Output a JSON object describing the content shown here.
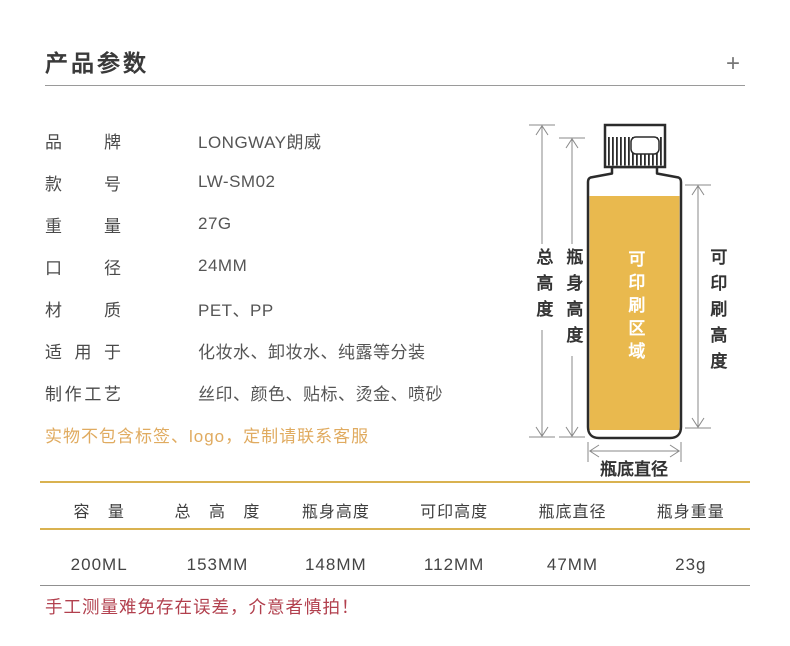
{
  "header": {
    "title": "产品参数",
    "expand_icon": "+"
  },
  "params": [
    {
      "label": "品牌",
      "value": "LONGWAY朗威"
    },
    {
      "label": "款号",
      "value": "LW-SM02"
    },
    {
      "label": "重量",
      "value": "27G"
    },
    {
      "label": "口径",
      "value": "24MM"
    },
    {
      "label": "材质",
      "value": "PET、PP"
    },
    {
      "label": "适用于",
      "value": "化妆水、卸妆水、纯露等分装"
    },
    {
      "label": "制作工艺",
      "value": "丝印、颜色、贴标、烫金、喷砂"
    }
  ],
  "note_warning": "实物不包含标签、logo，定制请联系客服",
  "diagram": {
    "labels": {
      "total_height": "总高度",
      "body_height": "瓶身高度",
      "printable_area": "可印刷区域",
      "printable_height": "可印刷高度",
      "bottom_diameter": "瓶底直径"
    },
    "colors": {
      "printable_fill": "#e9b94e",
      "bottle_outline": "#2b2b2b",
      "dimension_line": "#8a8a8a"
    }
  },
  "spec_table": {
    "headers": [
      "容 量",
      "总 高 度",
      "瓶身高度",
      "可印高度",
      "瓶底直径",
      "瓶身重量"
    ],
    "values": [
      "200ML",
      "153MM",
      "148MM",
      "112MM",
      "47MM",
      "23g"
    ],
    "accent_color": "#d9b250"
  },
  "disclaimer": "手工测量难免存在误差，介意者慎拍！",
  "colors": {
    "title_text": "#3a3a3a",
    "note_text": "#e0ab60",
    "disclaimer_text": "#b2404e"
  }
}
